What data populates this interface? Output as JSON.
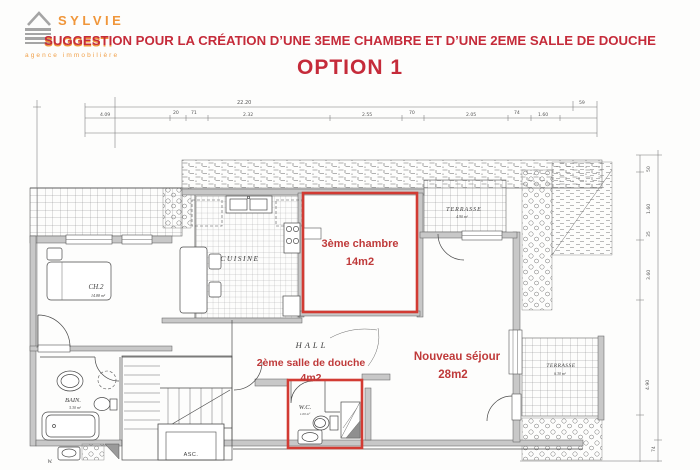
{
  "header": {
    "logo": {
      "name": "SYLVIE",
      "tagline": "agence immobilière"
    },
    "title": "SUGGESTION POUR LA CRÉATION D’UNE 3EME CHAMBRE ET D’UNE 2EME SALLE DE DOUCHE",
    "option": "OPTION 1"
  },
  "colors": {
    "title_red": "#c52b3a",
    "annotation_red": "#bf3a3a",
    "highlight_red": "#d23b33",
    "logo_orange": "#f0963a",
    "logo_gray": "#a5a5a5"
  },
  "plan": {
    "proposal": {
      "chambre": {
        "label": "3ème chambre",
        "area": "14m2"
      },
      "douche": {
        "label": "2ème salle de douche",
        "area": "4m2"
      },
      "sejour": {
        "label": "Nouveau séjour",
        "area": "28m2"
      }
    },
    "rooms": {
      "cuisine": "CUISINE",
      "hall": "HALL",
      "ch2": {
        "label": "CH.2",
        "area": "14.88 m²"
      },
      "bain": {
        "label": "BAIN.",
        "area": "5.30 m²"
      },
      "wc": {
        "label": "W.C.",
        "area": "1.00 m²"
      },
      "asc": "ASC.",
      "wc2": "W.",
      "terrasse_top": {
        "label": "TERRASSE",
        "area": "4.90 m²"
      },
      "terrasse_right": {
        "label": "TERRASSE",
        "area": "6.30 m²"
      }
    },
    "dims": {
      "overall": "22.20",
      "right_top": "59",
      "top": [
        "4.09",
        "20",
        "71",
        "2.32",
        "2.55",
        "70",
        "2.05",
        "74",
        "1.60"
      ],
      "right": [
        "50",
        "1.60",
        "35",
        "3.60",
        "4.90",
        "74"
      ]
    }
  }
}
